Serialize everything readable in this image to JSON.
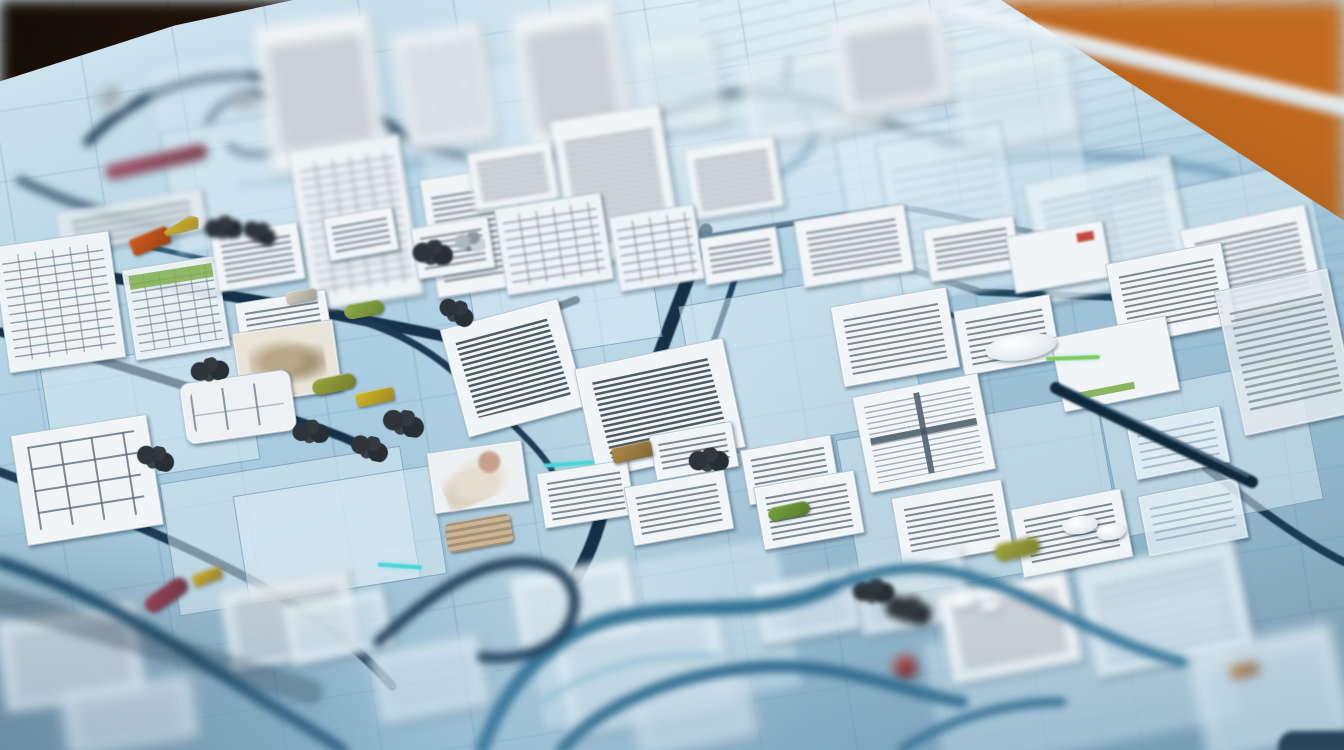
{
  "scene": {
    "description": "Photograph of a light-blue blueprint board on a wooden table, covered with winding dark navy route lines, scattered white scribbled paper cards, tiny colored chips and bead clusters; shallow depth of field blurs the top and bottom of the frame.",
    "legible_text": "none"
  },
  "palette": {
    "board_light": "#d3e6f0",
    "board_mid": "#a9cde1",
    "board_deep": "#8fb4c9",
    "board_shadow": "#7293a6",
    "card_white": "#f1f5f7",
    "card_border": "#b7c9d3",
    "wood_dark": "#3a2113",
    "wood_orange": "#b05f1f",
    "line_navy": "#16324a",
    "line_teal": "#2f7093",
    "accent_cyan": "#49d6d6",
    "accent_green": "#7fc95c"
  },
  "cards_fields": "x,y,w,h,rotation_deg,type",
  "cards": [
    [
      262,
      18,
      118,
      150,
      -8,
      "doc"
    ],
    [
      398,
      28,
      92,
      118,
      -9,
      "table"
    ],
    [
      520,
      8,
      104,
      138,
      -9,
      "doc"
    ],
    [
      636,
      38,
      84,
      92,
      -8,
      "pale"
    ],
    [
      742,
      52,
      140,
      84,
      -8,
      "pale"
    ],
    [
      836,
      14,
      112,
      96,
      -9,
      "doc"
    ],
    [
      956,
      55,
      118,
      88,
      -10,
      "pale"
    ],
    [
      150,
      58,
      104,
      72,
      -10,
      "panel"
    ],
    [
      300,
      142,
      112,
      162,
      -9,
      "table"
    ],
    [
      428,
      172,
      94,
      120,
      -9,
      "doc"
    ],
    [
      560,
      112,
      112,
      148,
      -9,
      "doc"
    ],
    [
      688,
      142,
      92,
      72,
      -9,
      "doc"
    ],
    [
      888,
      132,
      128,
      164,
      -10,
      "panel"
    ],
    [
      1034,
      168,
      150,
      122,
      -12,
      "pale"
    ],
    [
      1188,
      216,
      128,
      96,
      -12,
      "doc"
    ],
    [
      470,
      146,
      86,
      60,
      -9,
      "doc"
    ],
    [
      58,
      200,
      148,
      42,
      -10,
      "striped"
    ],
    [
      0,
      238,
      118,
      128,
      -8,
      "table"
    ],
    [
      128,
      262,
      96,
      92,
      -9,
      "tableg"
    ],
    [
      214,
      228,
      88,
      58,
      -9,
      "doc"
    ],
    [
      326,
      212,
      70,
      44,
      -10,
      "doc"
    ],
    [
      414,
      222,
      78,
      52,
      -9,
      "doc"
    ],
    [
      500,
      200,
      108,
      88,
      -9,
      "table"
    ],
    [
      614,
      210,
      86,
      76,
      -9,
      "table"
    ],
    [
      702,
      232,
      78,
      48,
      -9,
      "doc"
    ],
    [
      798,
      212,
      112,
      68,
      -9,
      "doc"
    ],
    [
      926,
      222,
      92,
      54,
      -9,
      "doc"
    ],
    [
      1010,
      228,
      98,
      58,
      -10,
      "docr"
    ],
    [
      1112,
      252,
      118,
      84,
      -11,
      "doc"
    ],
    [
      1228,
      278,
      116,
      148,
      -12,
      "striped"
    ],
    [
      836,
      296,
      118,
      82,
      -10,
      "doc"
    ],
    [
      958,
      302,
      98,
      66,
      -10,
      "doc"
    ],
    [
      1056,
      326,
      118,
      76,
      -11,
      "docg"
    ],
    [
      238,
      296,
      92,
      56,
      -9,
      "doc"
    ],
    [
      236,
      326,
      102,
      72,
      -8,
      "photo"
    ],
    [
      182,
      376,
      112,
      62,
      -8,
      "keyboard"
    ],
    [
      452,
      312,
      122,
      112,
      -15,
      "script"
    ],
    [
      584,
      352,
      152,
      112,
      -12,
      "script"
    ],
    [
      652,
      428,
      84,
      46,
      -10,
      "doc"
    ],
    [
      744,
      442,
      92,
      56,
      -10,
      "doc"
    ],
    [
      860,
      384,
      128,
      98,
      -11,
      "window"
    ],
    [
      1130,
      414,
      96,
      58,
      -11,
      "pale"
    ],
    [
      18,
      424,
      138,
      112,
      -9,
      "flow"
    ],
    [
      430,
      446,
      96,
      62,
      -8,
      "photo2"
    ],
    [
      540,
      466,
      92,
      56,
      -9,
      "doc"
    ],
    [
      628,
      478,
      102,
      60,
      -10,
      "doc"
    ],
    [
      758,
      478,
      102,
      64,
      -10,
      "doc"
    ],
    [
      896,
      488,
      112,
      70,
      -10,
      "doc"
    ],
    [
      1016,
      498,
      112,
      70,
      -11,
      "doc"
    ],
    [
      1142,
      486,
      102,
      62,
      -11,
      "pale"
    ],
    [
      224,
      580,
      132,
      82,
      -10,
      "striped"
    ],
    [
      0,
      612,
      142,
      92,
      -8,
      "striped"
    ],
    [
      286,
      596,
      104,
      62,
      -12,
      "pale"
    ],
    [
      514,
      566,
      122,
      82,
      -10,
      "pale"
    ],
    [
      556,
      612,
      172,
      112,
      -11,
      "palerows"
    ],
    [
      756,
      576,
      102,
      62,
      -10,
      "pale"
    ],
    [
      856,
      556,
      112,
      72,
      -10,
      "pale"
    ],
    [
      944,
      582,
      132,
      92,
      -11,
      "doc"
    ],
    [
      1084,
      552,
      162,
      112,
      -12,
      "palerows"
    ],
    [
      1196,
      636,
      148,
      112,
      -12,
      "palerows"
    ],
    [
      632,
      676,
      122,
      72,
      -11,
      "pale"
    ],
    [
      374,
      644,
      112,
      72,
      -11,
      "pale"
    ],
    [
      64,
      684,
      132,
      64,
      -9,
      "striped"
    ]
  ],
  "zones_fields": "x,y,w,h,rotation_deg",
  "zones": [
    [
      418,
      58,
      224,
      164,
      -9
    ],
    [
      672,
      78,
      264,
      144,
      -9
    ],
    [
      168,
      116,
      204,
      124,
      -9
    ],
    [
      846,
      116,
      244,
      164,
      -10
    ],
    [
      470,
      228,
      184,
      124,
      -9
    ],
    [
      690,
      286,
      224,
      154,
      -10
    ],
    [
      168,
      464,
      244,
      134,
      -9
    ],
    [
      848,
      416,
      264,
      164,
      -10
    ],
    [
      1108,
      376,
      204,
      144,
      -11
    ],
    [
      528,
      556,
      264,
      154,
      -10
    ],
    [
      930,
      614,
      304,
      134,
      -11
    ],
    [
      48,
      352,
      204,
      124,
      -9
    ],
    [
      240,
      480,
      200,
      110,
      -9
    ],
    [
      1120,
      180,
      200,
      120,
      -12
    ]
  ],
  "chips_fields": "x,y,w,h,rotation_deg,color,shape",
  "chips": [
    [
      104,
      154,
      104,
      15,
      -13,
      "#a4546a",
      "pill"
    ],
    [
      130,
      232,
      40,
      18,
      -22,
      "#cf5a1d",
      "rect"
    ],
    [
      162,
      218,
      38,
      15,
      -14,
      "#d9bb2c",
      "wedge"
    ],
    [
      344,
      302,
      40,
      15,
      -10,
      "#8fae49",
      "pill"
    ],
    [
      312,
      376,
      44,
      16,
      -12,
      "#9aa63e",
      "pill"
    ],
    [
      356,
      390,
      38,
      14,
      -12,
      "#d3b82a",
      "rect"
    ],
    [
      142,
      586,
      48,
      18,
      -35,
      "#94465a",
      "pill"
    ],
    [
      192,
      570,
      30,
      13,
      -20,
      "#c9ae35",
      "rect"
    ],
    [
      612,
      444,
      40,
      16,
      -12,
      "#b08948",
      "rect"
    ],
    [
      768,
      504,
      42,
      14,
      -12,
      "#74a43c",
      "pill"
    ],
    [
      994,
      540,
      46,
      18,
      -12,
      "#a3a93e",
      "pill"
    ],
    [
      893,
      655,
      24,
      24,
      0,
      "#b23430",
      "round"
    ],
    [
      1230,
      664,
      28,
      12,
      -12,
      "#c77e3a",
      "rect"
    ],
    [
      446,
      518,
      66,
      30,
      -10,
      "#cbb594",
      "striped-chip"
    ],
    [
      286,
      290,
      30,
      12,
      -10,
      "#d8d2c4",
      "rect"
    ]
  ],
  "clusters_fields": "x,y,w,h,rotation_deg,variant",
  "clusters": [
    [
      204,
      216,
      40,
      24,
      -10,
      "dark"
    ],
    [
      242,
      222,
      36,
      22,
      15,
      "dark"
    ],
    [
      412,
      240,
      42,
      26,
      -5,
      "dark"
    ],
    [
      438,
      300,
      38,
      24,
      20,
      "dark"
    ],
    [
      190,
      358,
      40,
      24,
      -15,
      "dark"
    ],
    [
      382,
      410,
      44,
      26,
      8,
      "dark"
    ],
    [
      292,
      420,
      38,
      24,
      -8,
      "dark"
    ],
    [
      350,
      436,
      40,
      24,
      12,
      "dark"
    ],
    [
      852,
      578,
      44,
      26,
      -6,
      "dark"
    ],
    [
      884,
      596,
      50,
      28,
      6,
      "dark"
    ],
    [
      688,
      448,
      42,
      24,
      -10,
      "dark"
    ],
    [
      136,
      446,
      40,
      24,
      10,
      "dark"
    ],
    [
      92,
      88,
      36,
      22,
      -12,
      "metal"
    ],
    [
      228,
      90,
      34,
      20,
      14,
      "metal"
    ],
    [
      452,
      232,
      36,
      20,
      -6,
      "metal"
    ]
  ],
  "ovals_fields": "x,y,w,h",
  "ovals": [
    [
      1062,
      516,
      36,
      18
    ],
    [
      1096,
      524,
      30,
      16
    ],
    [
      950,
      594,
      28,
      14
    ],
    [
      980,
      600,
      22,
      12
    ],
    [
      985,
      334,
      72,
      26
    ]
  ],
  "accents_fields": "x,y,w,h,rotation_deg,color",
  "accents": [
    [
      544,
      462,
      50,
      4,
      -4,
      "#49d6d6"
    ],
    [
      1046,
      356,
      54,
      4,
      -2,
      "#7fc95c"
    ],
    [
      378,
      564,
      44,
      4,
      4,
      "#49d6d6"
    ]
  ],
  "routes_fields": "band,path,stroke,width,opacity",
  "routes": [
    [
      "far",
      "M 88,142 C 150,74 252,58 330,96 C 424,142 470,178 562,152 C 660,124 700,82 792,96 C 880,110 924,152 982,140",
      "#1d3a52",
      9,
      1
    ],
    [
      "far",
      "M 208,122 C 226,86 288,84 300,118 C 310,148 252,166 230,146",
      "#1d3a52",
      7,
      1
    ],
    [
      "far",
      "M 238,186 L 975,96",
      "#5a87a6",
      2.5,
      0.9
    ],
    [
      "far",
      "M 790,62 C 772,96 822,112 812,142 C 803,170 760,176 744,200",
      "#2e6b94",
      6,
      1
    ],
    [
      "far",
      "M 20,180 C 60,200 120,220 180,232",
      "#24465f",
      7,
      1
    ],
    [
      "far",
      "M 995,160 C 1060,150 1150,155 1230,175",
      "#4a7c9c",
      5,
      0.9
    ],
    [
      "mid",
      "M 0,262 C 120,278 262,300 352,318 C 422,332 452,336 472,346",
      "#16324a",
      11,
      1
    ],
    [
      "mid",
      "M 0,332 C 92,356 172,382 242,404 C 302,422 332,432 354,442",
      "#16324a",
      9,
      1
    ],
    [
      "mid",
      "M 352,318 C 392,330 424,346 454,372 C 472,386 482,396 490,410",
      "#1b3a54",
      7,
      1
    ],
    [
      "mid",
      "M 706,230 C 688,280 668,330 650,380 C 636,420 614,470 600,520 C 592,548 584,562 576,578",
      "#142f46",
      13,
      1
    ],
    [
      "mid",
      "M 744,248 C 732,290 718,332 700,376",
      "#1d4160",
      6,
      1
    ],
    [
      "mid",
      "M 700,238 L 898,206 L 1042,234",
      "#1f455f",
      6,
      1
    ],
    [
      "mid",
      "M 858,252 L 980,292 L 1180,300",
      "#1f455f",
      7,
      1
    ],
    [
      "mid",
      "M 920,300 C 962,322 992,330 1032,330",
      "#2a567a",
      5,
      1
    ],
    [
      "mid",
      "M 470,346 C 512,330 542,312 576,300",
      "#16324a",
      8,
      1
    ],
    [
      "mid",
      "M 0,472 C 82,502 182,542 262,586 C 332,626 362,652 392,686",
      "#1d3c55",
      9,
      1
    ],
    [
      "mid",
      "M 978,352 L 1112,344",
      "#35657f",
      4,
      0.9
    ],
    [
      "mid",
      "M 1206,468 C 1258,508 1300,540 1344,562",
      "#1b3a54",
      8,
      1
    ],
    [
      "mid",
      "M 498,410 C 520,432 540,450 552,470",
      "#1b3a54",
      6,
      1
    ],
    [
      "mid",
      "M 136,244 C 180,254 220,262 262,272",
      "#27506e",
      5,
      0.9
    ],
    [
      "pen",
      "M 1056,388 L 1252,482",
      "#10283c",
      12,
      1
    ],
    [
      "pen",
      "M 1060,384 L 1248,476",
      "#8cbedc",
      2,
      0.55
    ],
    [
      "near",
      "M 482,750 C 502,692 542,642 602,622 C 682,597 762,622 832,587",
      "#2f7093",
      14,
      1
    ],
    [
      "near",
      "M 562,750 C 602,702 682,672 762,667 C 842,662 902,692 962,702",
      "#2a6486",
      12,
      1
    ],
    [
      "near",
      "M 832,587 C 882,567 922,562 972,577 C 1042,597 1102,642 1182,662",
      "#2f7093",
      10,
      1
    ],
    [
      "near",
      "M 0,562 C 62,582 142,622 202,662 C 262,702 302,722 342,750",
      "#24506e",
      12,
      1
    ],
    [
      "near",
      "M 902,750 C 942,722 1002,702 1062,702",
      "#2a6486",
      9,
      1
    ],
    [
      "near",
      "M 542,702 C 602,662 662,652 722,657",
      "#7fb6cd",
      4,
      0.9
    ],
    [
      "near",
      "M 378,642 C 422,602 472,562 522,562 C 562,562 582,587 572,617 C 562,647 522,662 482,657",
      "#1b3a54",
      10,
      1
    ],
    [
      "near",
      "M 0,600 L 310,692",
      "rgba(25,45,60,0.32)",
      26,
      1
    ]
  ]
}
